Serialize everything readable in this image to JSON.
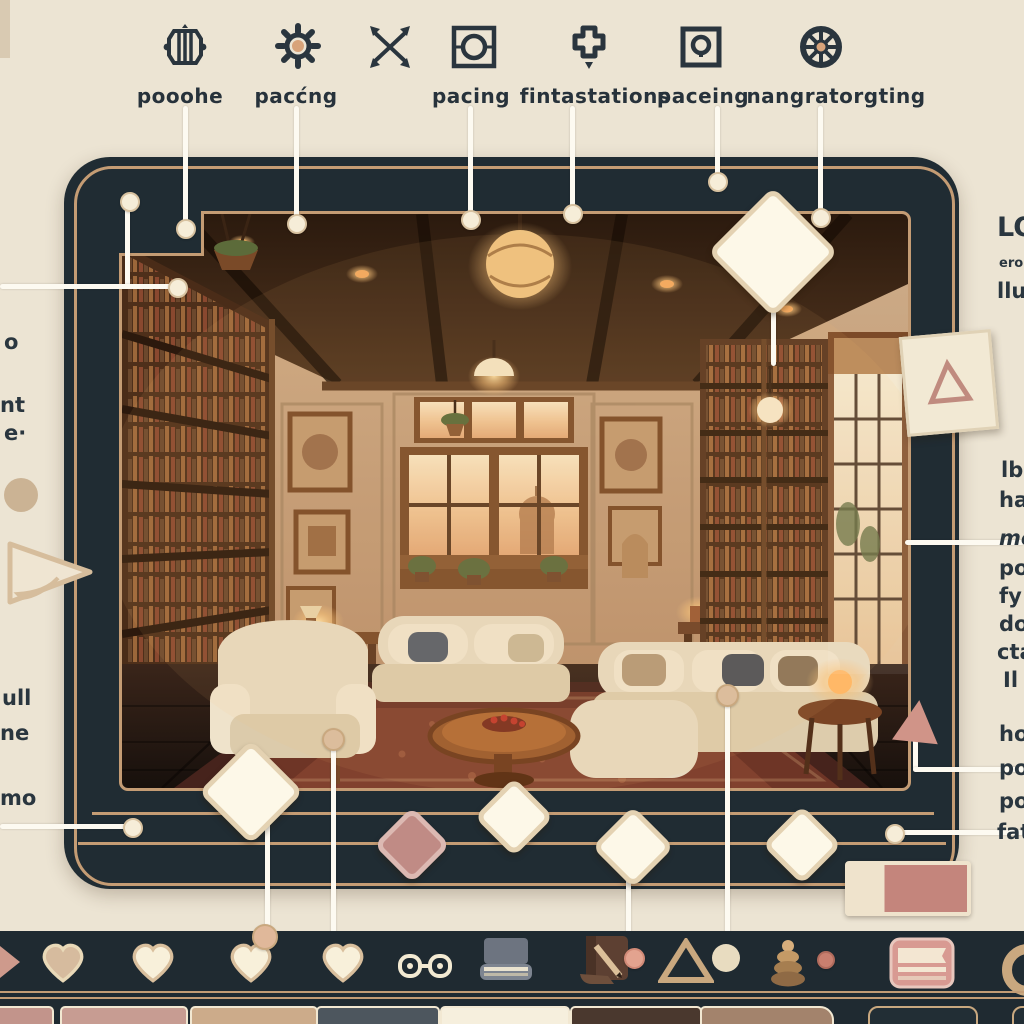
{
  "top_toolbar": {
    "items": [
      {
        "icon": "lantern-icon",
        "label": "pooohe"
      },
      {
        "icon": "gear-icon",
        "label": "pacćng"
      },
      {
        "icon": "crossed-arrows-icon",
        "label": ""
      },
      {
        "icon": "framed-circle-icon",
        "label": "pacing"
      },
      {
        "icon": "cross-badge-icon",
        "label": "fintastations"
      },
      {
        "icon": "keyhole-square-icon",
        "label": "paceing"
      },
      {
        "icon": "ship-wheel-icon",
        "label": "nangratorgting"
      }
    ]
  },
  "left_margin": {
    "fragments": [
      "o",
      "nt",
      "e·",
      "ull",
      "ne",
      "mo"
    ]
  },
  "right_margin": {
    "heading": "LO",
    "subheading": "ero",
    "fragments": [
      "llu",
      "lb",
      "ha",
      "me",
      "po",
      "fy",
      "do",
      "cta",
      "Il",
      "ho",
      "po",
      "po",
      "fat"
    ]
  },
  "colors": {
    "background": "#ece4d3",
    "frame_navy": "#202c33",
    "pinstripe_gold": "#c49c74",
    "cream": "#f7f1df",
    "rose_pink": "#c48d85",
    "label_text": "#27323b",
    "warm_lamp": "#f4c37a"
  },
  "bottom_toolbar": {
    "icons": [
      {
        "name": "heart-icon",
        "variant": "tan"
      },
      {
        "name": "heart-icon",
        "variant": "cream"
      },
      {
        "name": "heart-icon",
        "variant": "cream"
      },
      {
        "name": "heart-icon",
        "variant": "cream"
      },
      {
        "name": "game-controller-icon"
      },
      {
        "name": "book-icon"
      },
      {
        "name": "bookmark-pencil-icon"
      },
      {
        "name": "triangle-icon"
      },
      {
        "name": "circle-icon"
      },
      {
        "name": "zen-stones-icon"
      },
      {
        "name": "pink-book-icon"
      },
      {
        "name": "ring-icon"
      }
    ]
  },
  "swatches": [
    {
      "color": "#c2948b"
    },
    {
      "color": "#c79c92"
    },
    {
      "color": "#ccab8a"
    },
    {
      "color": "#4d565e"
    },
    {
      "color": "#f6efdd"
    },
    {
      "color": "#4a382e"
    },
    {
      "color": "#a3836c"
    },
    {
      "color": "#222e35"
    },
    {
      "color": "#222e35"
    }
  ]
}
